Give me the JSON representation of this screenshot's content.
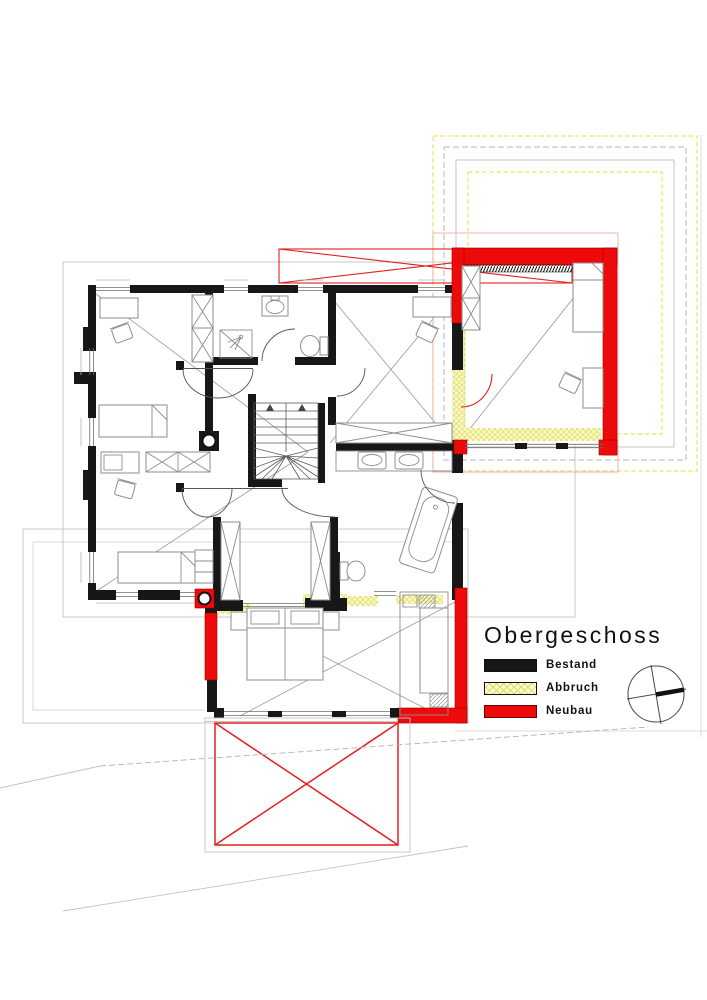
{
  "title": "Obergeschoss",
  "legend": {
    "items": [
      {
        "label": "Bestand",
        "key": "existing",
        "color": "#171717"
      },
      {
        "label": "Abbruch",
        "key": "demolition",
        "color": "#fcfbda"
      },
      {
        "label": "Neubau",
        "key": "new",
        "color": "#ee0a0a"
      }
    ]
  },
  "icons": {
    "compass": "compass-north-arrow"
  },
  "colors": {
    "wall_existing": "#171717",
    "demolition_hatch": "#e3e05a",
    "new_construction": "#ee0a0a",
    "site_lines": "#c3c3c3",
    "furniture_lines": "#8e8e8e",
    "background": "#ffffff"
  }
}
